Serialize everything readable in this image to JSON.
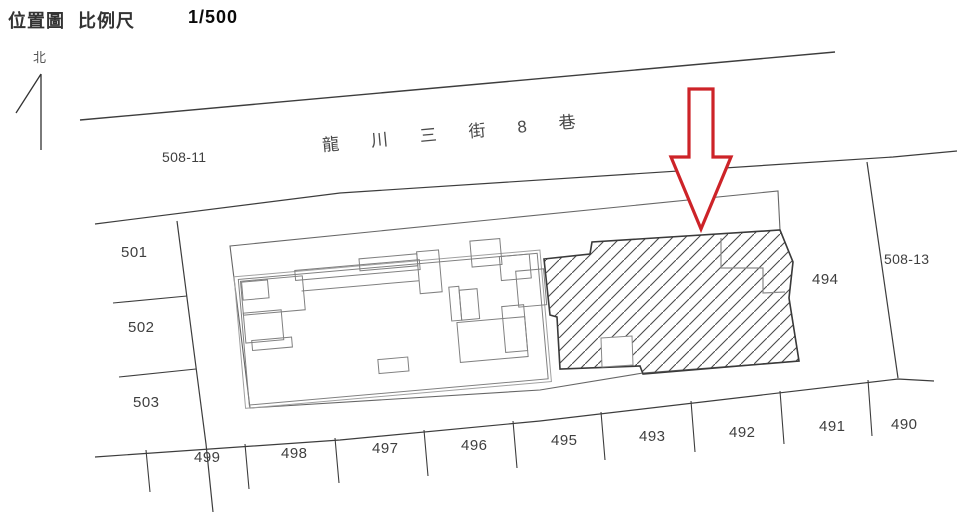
{
  "title": {
    "map_title": "位置圖",
    "scale_label": "比例尺",
    "scale_value": "1/500"
  },
  "north": {
    "label": "北"
  },
  "street": {
    "name": "龍川三街8巷"
  },
  "parcels": {
    "p508_11": "508-11",
    "p501": "501",
    "p502": "502",
    "p503": "503",
    "p499": "499",
    "p498": "498",
    "p497": "497",
    "p496": "496",
    "p495": "495",
    "p493": "493",
    "p492": "492",
    "p491": "491",
    "p490": "490",
    "p494": "494",
    "p508_13": "508-13"
  },
  "colors": {
    "line_dark": "#3d3d3d",
    "line_mid": "#666666",
    "line_light": "#808080",
    "highlight_arrow_red": "#cd2328",
    "label_text": "#3f3f3f"
  }
}
